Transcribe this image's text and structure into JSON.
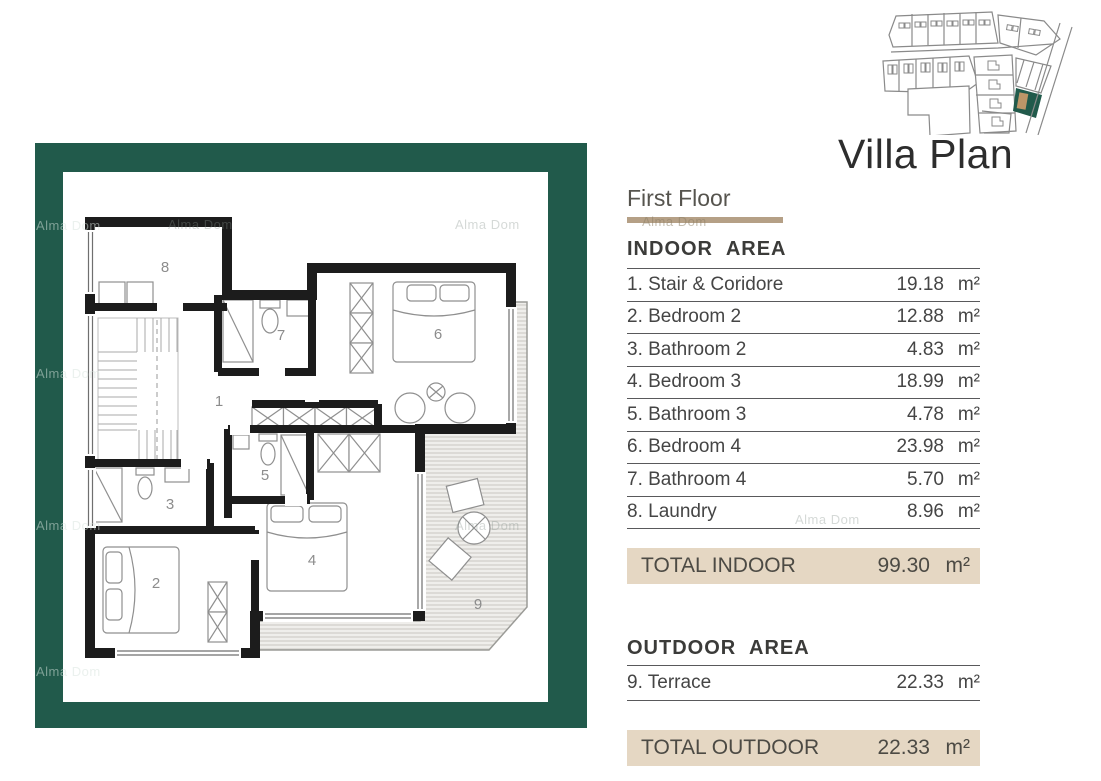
{
  "title": "Villa Plan",
  "panel": {
    "floor_label": "First Floor",
    "indoor": {
      "heading": "INDOOR AREA",
      "rows": [
        {
          "name": "1. Stair & Coridore",
          "value": "19.18",
          "unit": "m²"
        },
        {
          "name": "2. Bedroom 2",
          "value": "12.88",
          "unit": "m²"
        },
        {
          "name": "3. Bathroom 2",
          "value": "4.83",
          "unit": "m²"
        },
        {
          "name": "4. Bedroom 3",
          "value": "18.99",
          "unit": "m²"
        },
        {
          "name": "5. Bathroom 3",
          "value": "4.78",
          "unit": "m²"
        },
        {
          "name": "6. Bedroom 4",
          "value": "23.98",
          "unit": "m²"
        },
        {
          "name": "7. Bathroom 4",
          "value": "5.70",
          "unit": "m²"
        },
        {
          "name": "8. Laundry",
          "value": "8.96",
          "unit": "m²"
        }
      ],
      "total_label": "TOTAL INDOOR",
      "total_value": "99.30",
      "total_unit": "m²"
    },
    "outdoor": {
      "heading": "OUTDOOR AREA",
      "rows": [
        {
          "name": "9. Terrace",
          "value": "22.33",
          "unit": "m²"
        }
      ],
      "total_label": "TOTAL OUTDOOR",
      "total_value": "22.33",
      "total_unit": "m²"
    }
  },
  "floorplan": {
    "rooms": [
      {
        "number": "1"
      },
      {
        "number": "2"
      },
      {
        "number": "3"
      },
      {
        "number": "4"
      },
      {
        "number": "5"
      },
      {
        "number": "6"
      },
      {
        "number": "7"
      },
      {
        "number": "8"
      },
      {
        "number": "9"
      }
    ]
  },
  "watermark": {
    "text": "Alma Dom"
  },
  "colors": {
    "frame_teal": "#215a4b",
    "divider_tan": "#b5a086",
    "total_bar_bg": "#e5d7c3",
    "wall_black": "#1c1c1c",
    "highlight_plot_teal": "#215a4b",
    "highlight_house_tan": "#bd9668"
  }
}
